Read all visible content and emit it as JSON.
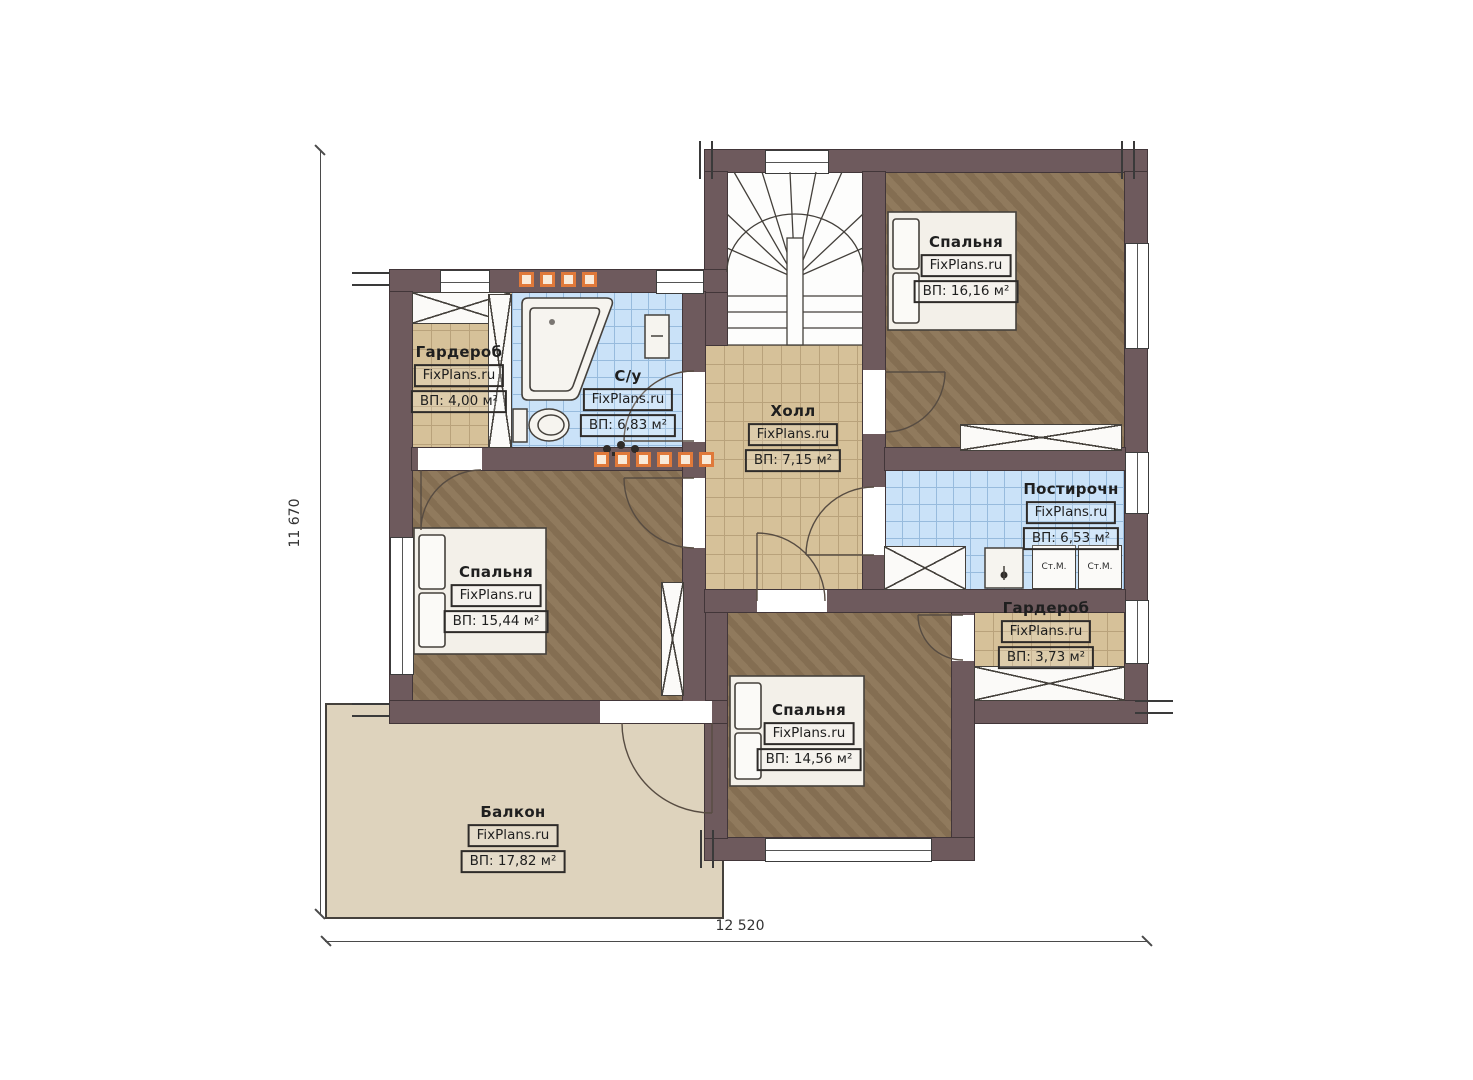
{
  "watermark": "FixPlans.ru",
  "dimensions": {
    "horizontal": "12 520",
    "vertical": "11 670"
  },
  "rooms": [
    {
      "id": "wardrobe-top-left",
      "name": "Гардероб",
      "area": "ВП: 4,00 м²"
    },
    {
      "id": "bathroom",
      "name": "С/у",
      "area": "ВП: 6,83 м²"
    },
    {
      "id": "hall",
      "name": "Холл",
      "area": "ВП: 7,15 м²"
    },
    {
      "id": "bedroom-top-right",
      "name": "Спальня",
      "area": "ВП: 16,16 м²"
    },
    {
      "id": "laundry",
      "name": "Постирочн",
      "area": "ВП: 6,53 м²"
    },
    {
      "id": "bedroom-left",
      "name": "Спальня",
      "area": "ВП: 15,44 м²"
    },
    {
      "id": "wardrobe-right",
      "name": "Гардероб",
      "area": "ВП: 3,73 м²"
    },
    {
      "id": "bedroom-bottom",
      "name": "Спальня",
      "area": "ВП: 14,56 м²"
    },
    {
      "id": "balcony",
      "name": "Балкон",
      "area": "ВП: 17,82 м²"
    }
  ],
  "appliances": [
    {
      "label": "Ст.М."
    },
    {
      "label": "Ст.М."
    }
  ],
  "colors": {
    "wall": "#6e5a5d",
    "wall_edge": "#423639",
    "wood": "#8b7456",
    "tile_tan": "#d6c199",
    "tile_tan_line": "#b9a27b",
    "tile_blue": "#cae2f8",
    "tile_blue_line": "#97bbdd",
    "balcony": "#ded3bd",
    "fixture": "#f6f4ef",
    "fixture_edge": "#45413c",
    "heat": "#e0793a",
    "heat_fill": "#f9ead9",
    "label_ink": "#1f1f1f",
    "label_border": "#2e2b29",
    "dim": "#4a4a4a"
  },
  "icons": [
    "stairs-icon",
    "bed-icon",
    "pillow-icon",
    "bathtub-icon",
    "toilet-icon",
    "sink-icon",
    "cabinet-icon",
    "washing-machine-icon",
    "wardrobe-closet-icon",
    "door-arc-icon",
    "window-icon",
    "heated-floor-marker-icon"
  ]
}
